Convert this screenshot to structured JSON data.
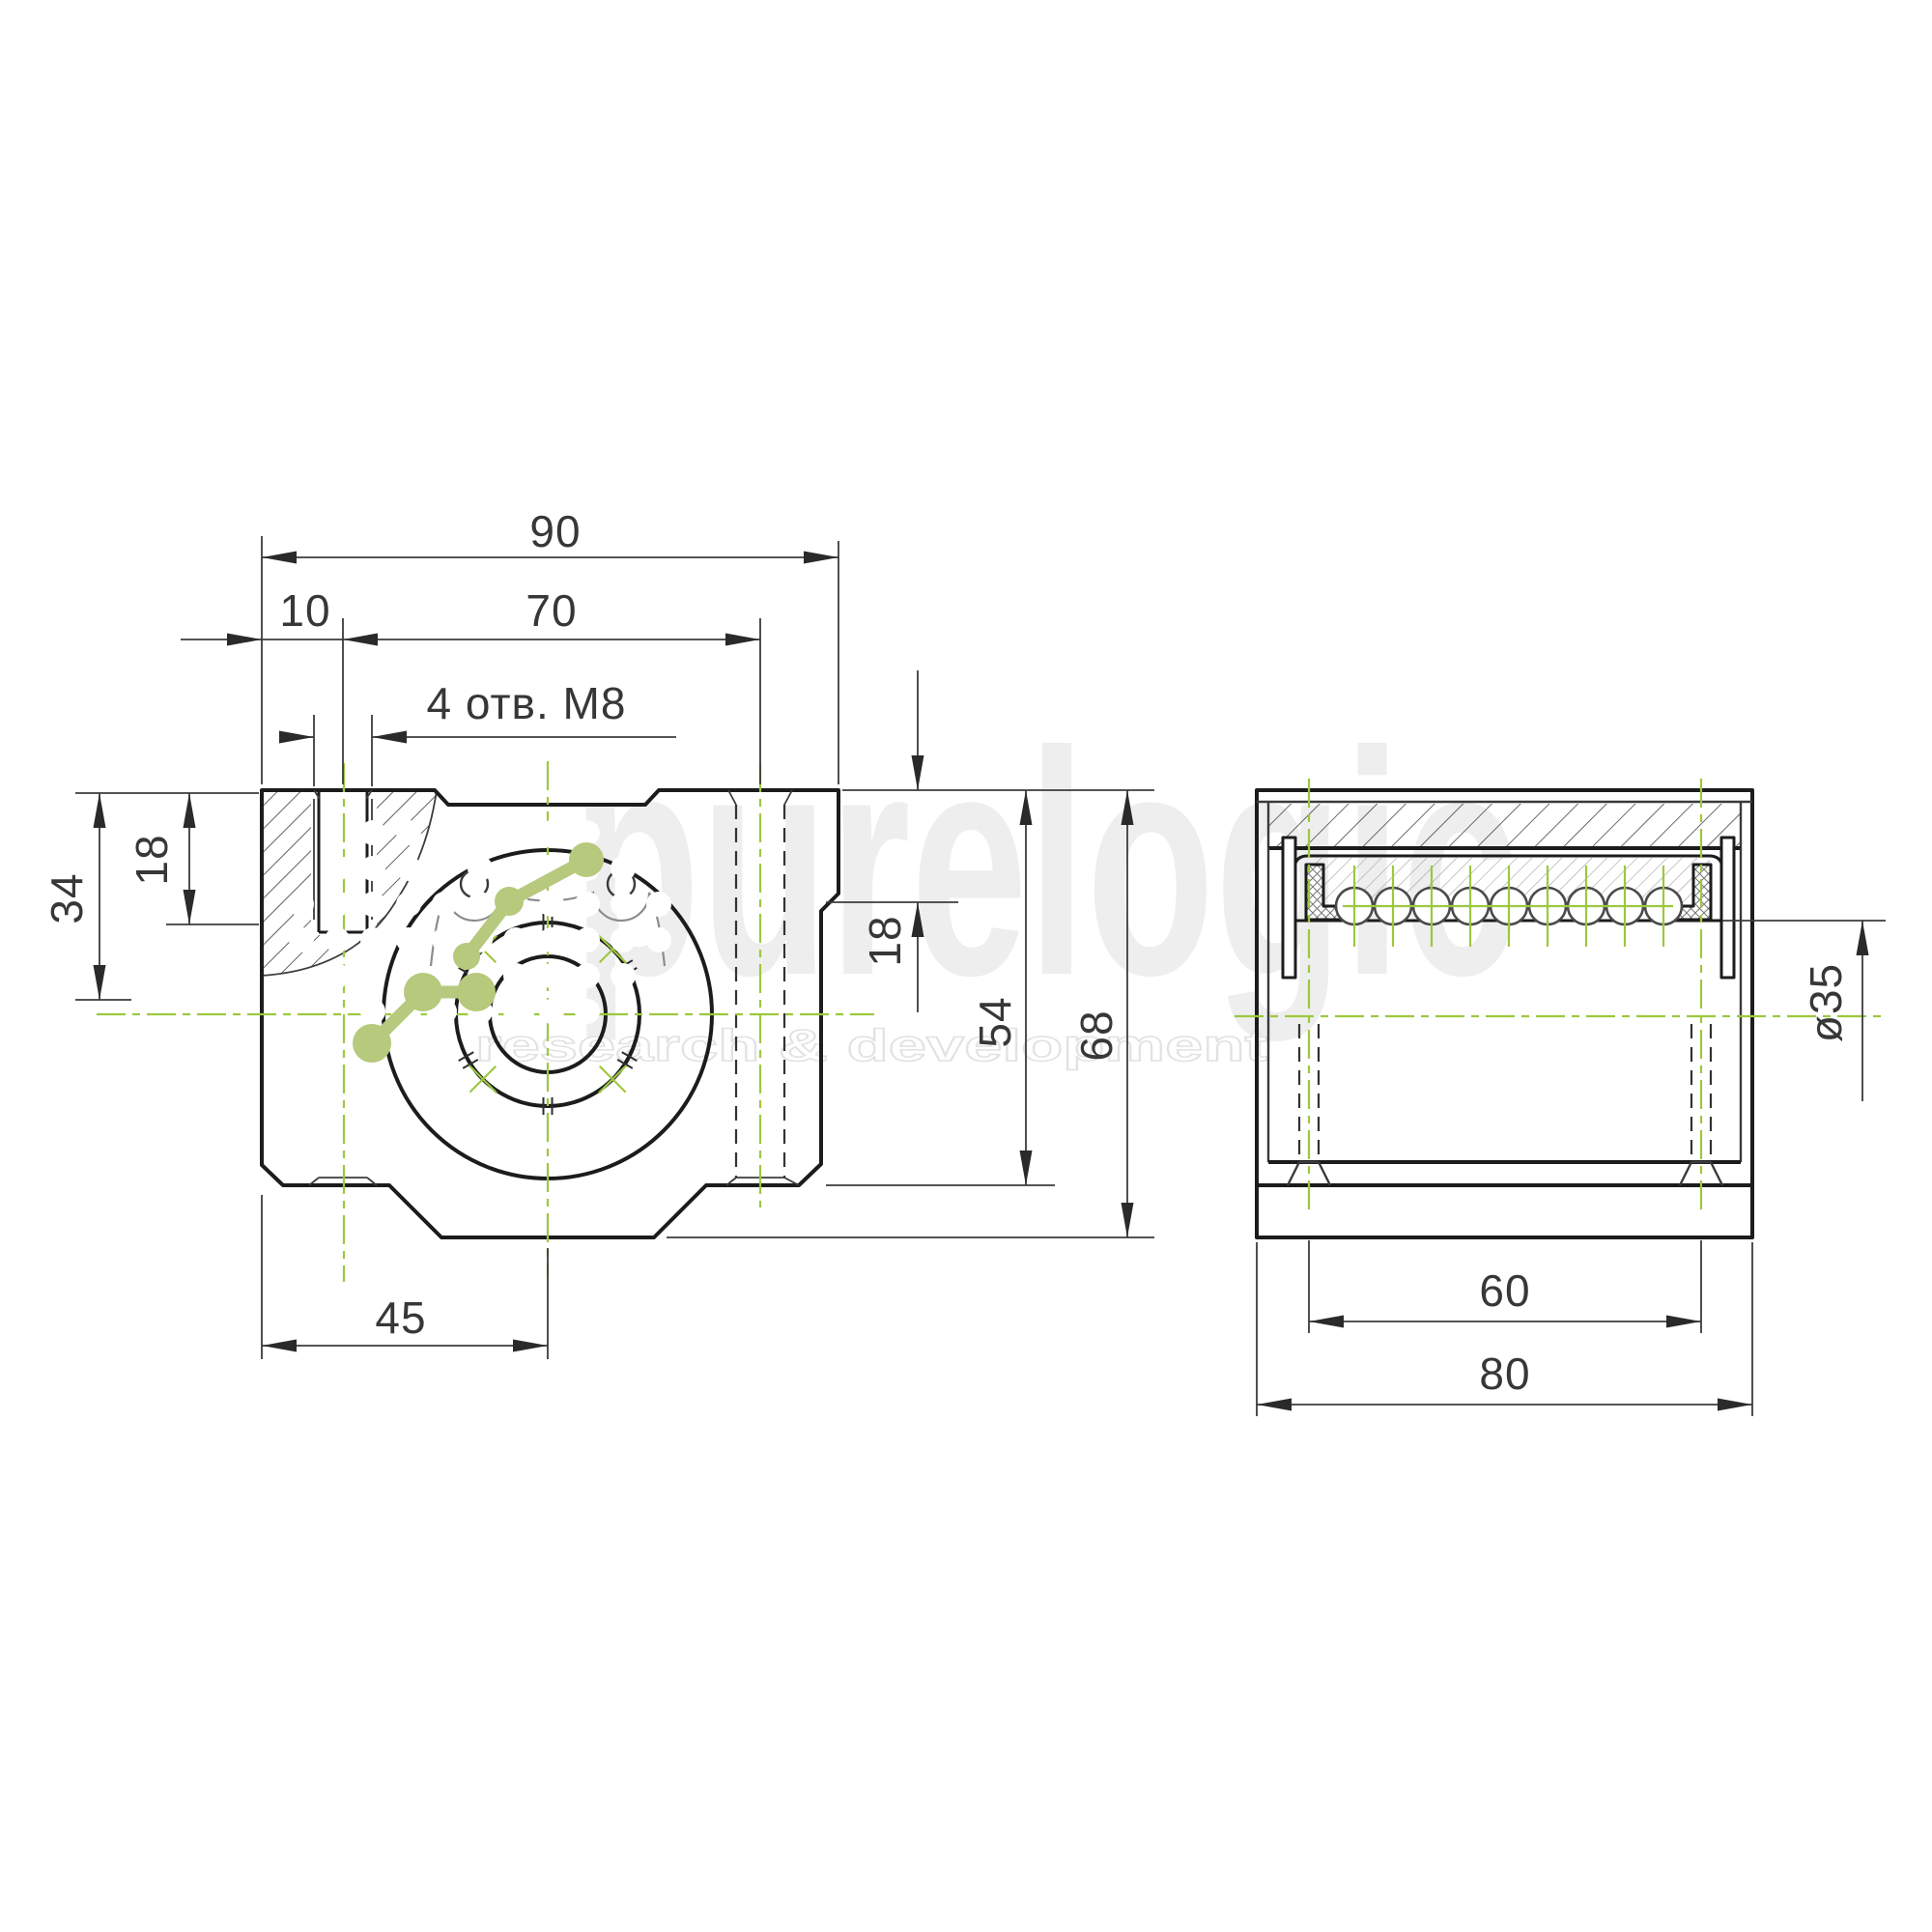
{
  "drawing": {
    "type": "technical-drawing",
    "views": {
      "front": "front-view",
      "side": "side-section-view"
    },
    "dimensions": {
      "overall_width": "90",
      "hole_offset": "10",
      "hole_spacing_top": "70",
      "thread_note": "4 отв. М8",
      "flange_depth": "18",
      "center_height": "34",
      "step_height": "18",
      "side_height": "54",
      "overall_height": "68",
      "base_to_center": "45",
      "bore_diameter": "ø35",
      "hole_spacing_side": "60",
      "overall_length": "80"
    },
    "side_view": {
      "ball_count": 9
    },
    "colors": {
      "outline": "#1c1c1c",
      "thin_line": "#3c3c3c",
      "gray_line": "#8c8c8c",
      "centerline_green": "#9cc83e",
      "watermark_green": "#b6c97c",
      "watermark_gray": "#ededed",
      "dim_text": "#373737",
      "background": "#ffffff"
    }
  },
  "watermark": {
    "brand": "purelogic",
    "tagline": "research & development"
  }
}
